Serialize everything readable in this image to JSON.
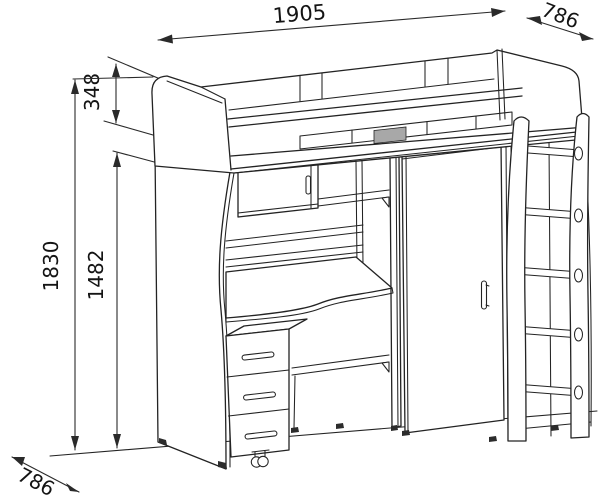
{
  "drawing": {
    "subject": "loft bed unit with wardrobe, corner desk, shelves, drawer pedestal and ladder",
    "dimensions": {
      "width": "1905",
      "depth_top": "786",
      "bed_section_height": "348",
      "overall_height": "1830",
      "underbed_height": "1482",
      "depth_bottom": "786"
    },
    "colors": {
      "line": "#232323",
      "background": "#ffffff",
      "shaded_patch": "#a8a8a8"
    }
  }
}
